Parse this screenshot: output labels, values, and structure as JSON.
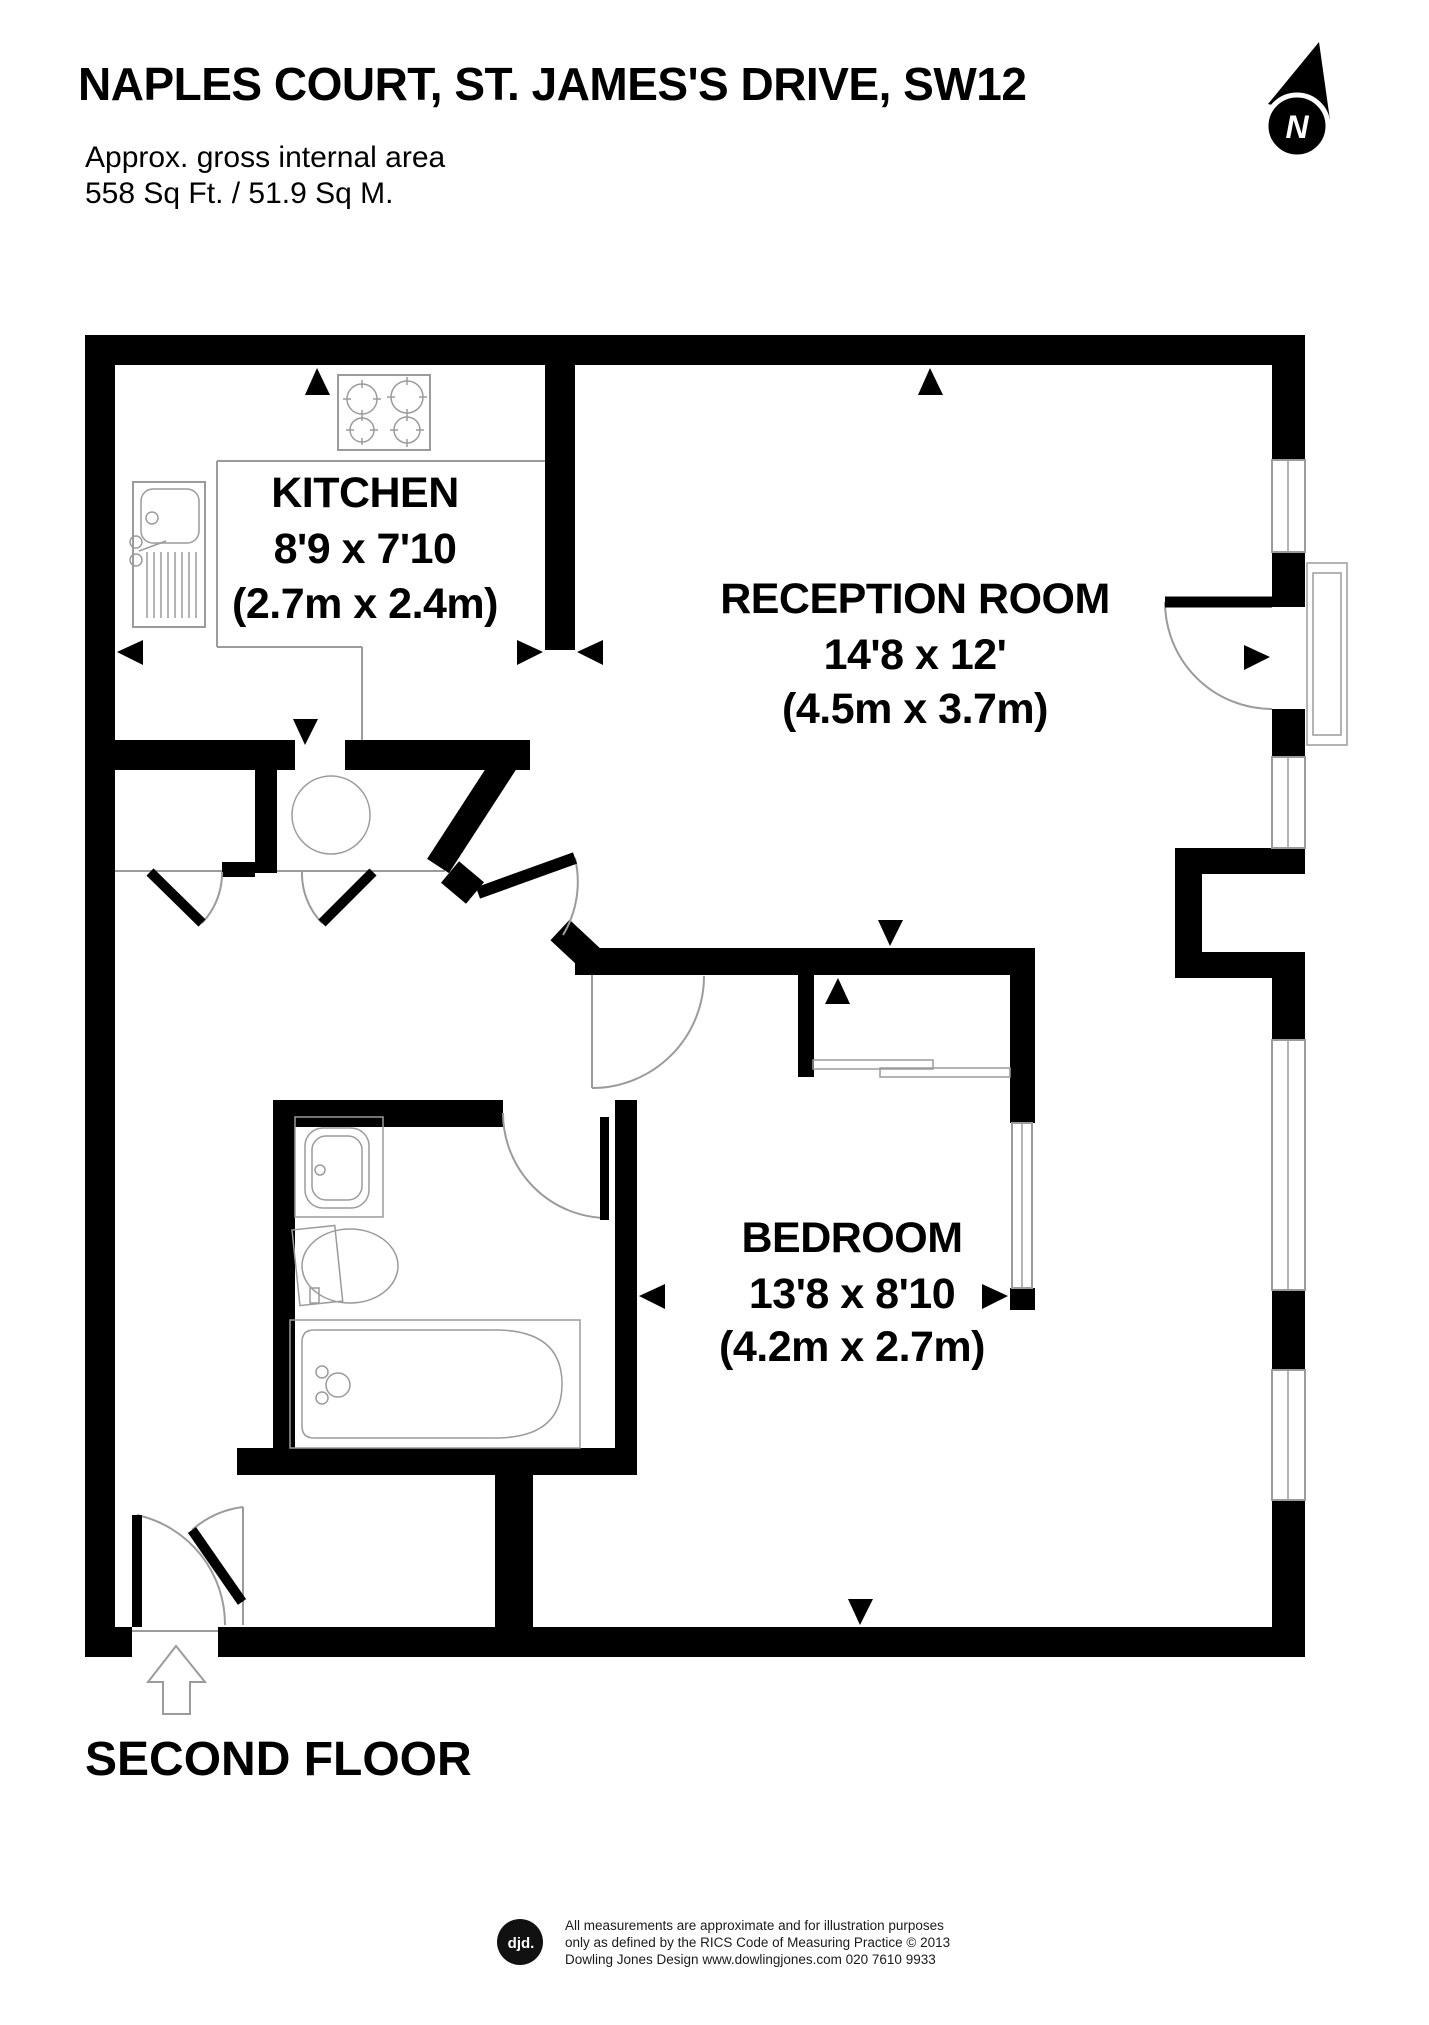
{
  "header": {
    "title": "NAPLES COURT, ST. JAMES'S DRIVE, SW12",
    "subtitle": "Approx. gross internal area",
    "area": "558 Sq Ft. / 51.9 Sq M."
  },
  "compass": {
    "north_label": "N"
  },
  "rooms": {
    "kitchen": {
      "name": "KITCHEN",
      "size_imperial": "8'9 x 7'10",
      "size_metric": "(2.7m x 2.4m)"
    },
    "reception": {
      "name": "RECEPTION ROOM",
      "size_imperial": "14'8 x 12'",
      "size_metric": "(4.5m x 3.7m)"
    },
    "bedroom": {
      "name": "BEDROOM",
      "size_imperial": "13'8 x 8'10",
      "size_metric": "(4.2m x 2.7m)"
    }
  },
  "floor_label": "SECOND FLOOR",
  "footer": {
    "logo_text": "djd.",
    "disclaimer_line1": "All measurements are approximate and for illustration purposes",
    "disclaimer_line2": "only as defined by the RICS Code of Measuring Practice © 2013",
    "disclaimer_line3": "Dowling Jones Design www.dowlingjones.com 020 7610 9933"
  }
}
